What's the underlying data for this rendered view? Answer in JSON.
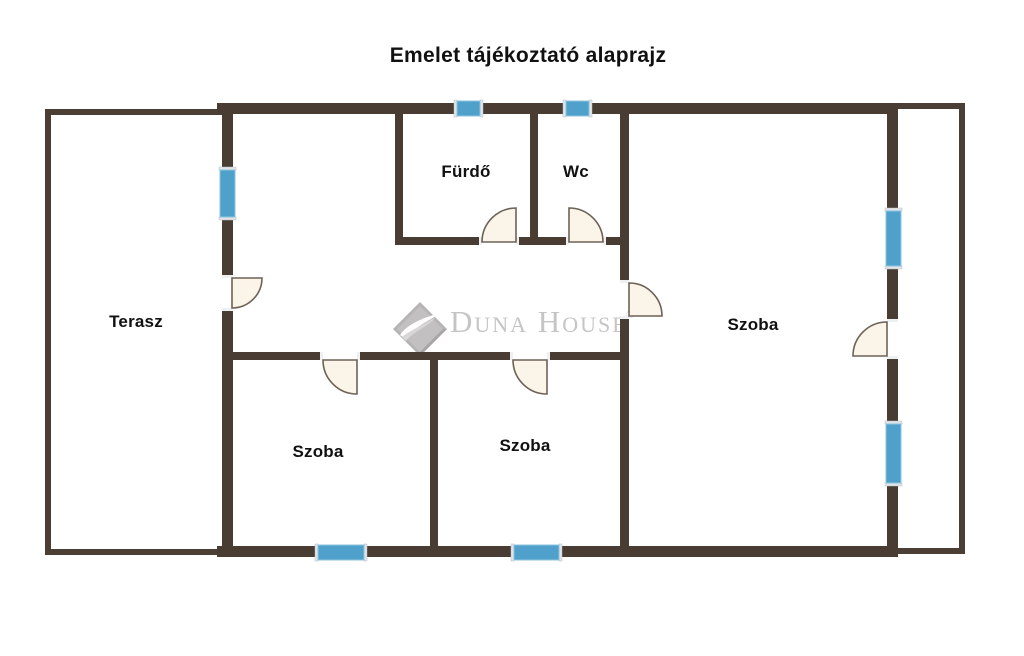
{
  "page": {
    "title": "Emelet tájékoztató alaprajz"
  },
  "floorplan": {
    "rooms": [
      {
        "id": "terasz",
        "label": "Terasz"
      },
      {
        "id": "furdo",
        "label": "Fürdő"
      },
      {
        "id": "wc",
        "label": "Wc"
      },
      {
        "id": "szoba-right",
        "label": "Szoba"
      },
      {
        "id": "szoba-bottom-left",
        "label": "Szoba"
      },
      {
        "id": "szoba-bottom-mid",
        "label": "Szoba"
      }
    ],
    "watermark": {
      "brand_display": "Duna House",
      "registered_mark": "®"
    },
    "colors": {
      "wall": "#483c33",
      "window_blue": "#4fa1cc",
      "door_fill": "#fbf4e8",
      "door_stroke": "#6d6257",
      "watermark_gray": "#c6c4c5",
      "label_color": "#111111"
    }
  }
}
